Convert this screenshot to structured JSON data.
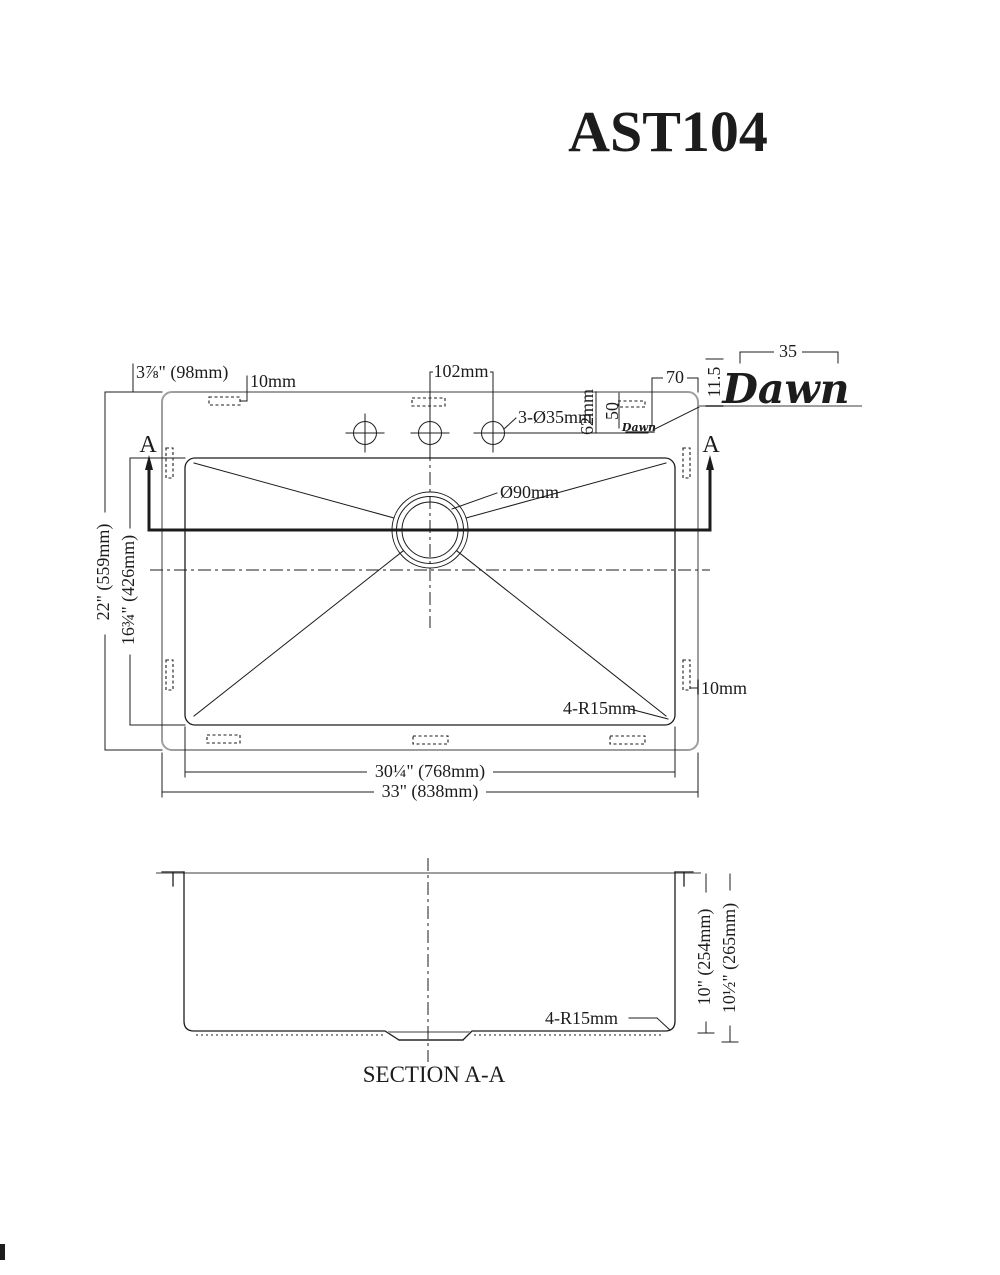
{
  "title": "AST104",
  "brand": {
    "logo": "Dawn",
    "stamp": "Dawn"
  },
  "colors": {
    "line": "#1c1c1c",
    "rim_gray": "#9e9e9e",
    "background": "#ffffff"
  },
  "top_view": {
    "marker_a_left": "A",
    "marker_a_right": "A",
    "dims": {
      "back_left_offset": "3⅞\" (98mm)",
      "clip_top": "10mm",
      "hole_spacing": "102mm",
      "holes": "3-Ø35mm",
      "hole_setback": "62mm",
      "logo_offset_x": "70",
      "logo_offset_y": "50",
      "logo_width": "35",
      "logo_height": "11.5",
      "drain": "Ø90mm",
      "overall_depth": "22\" (559mm)",
      "bowl_depth": "16¾\" (426mm)",
      "clip_right": "10mm",
      "corner_radius": "4-R15mm",
      "bowl_width": "30¼\" (768mm)",
      "overall_width": "33\" (838mm)"
    }
  },
  "section_view": {
    "dims": {
      "bowl_height": "10\" (254mm)",
      "overall_height": "10½\" (265mm)",
      "corner_radius": "4-R15mm"
    },
    "caption": "SECTION A-A"
  }
}
